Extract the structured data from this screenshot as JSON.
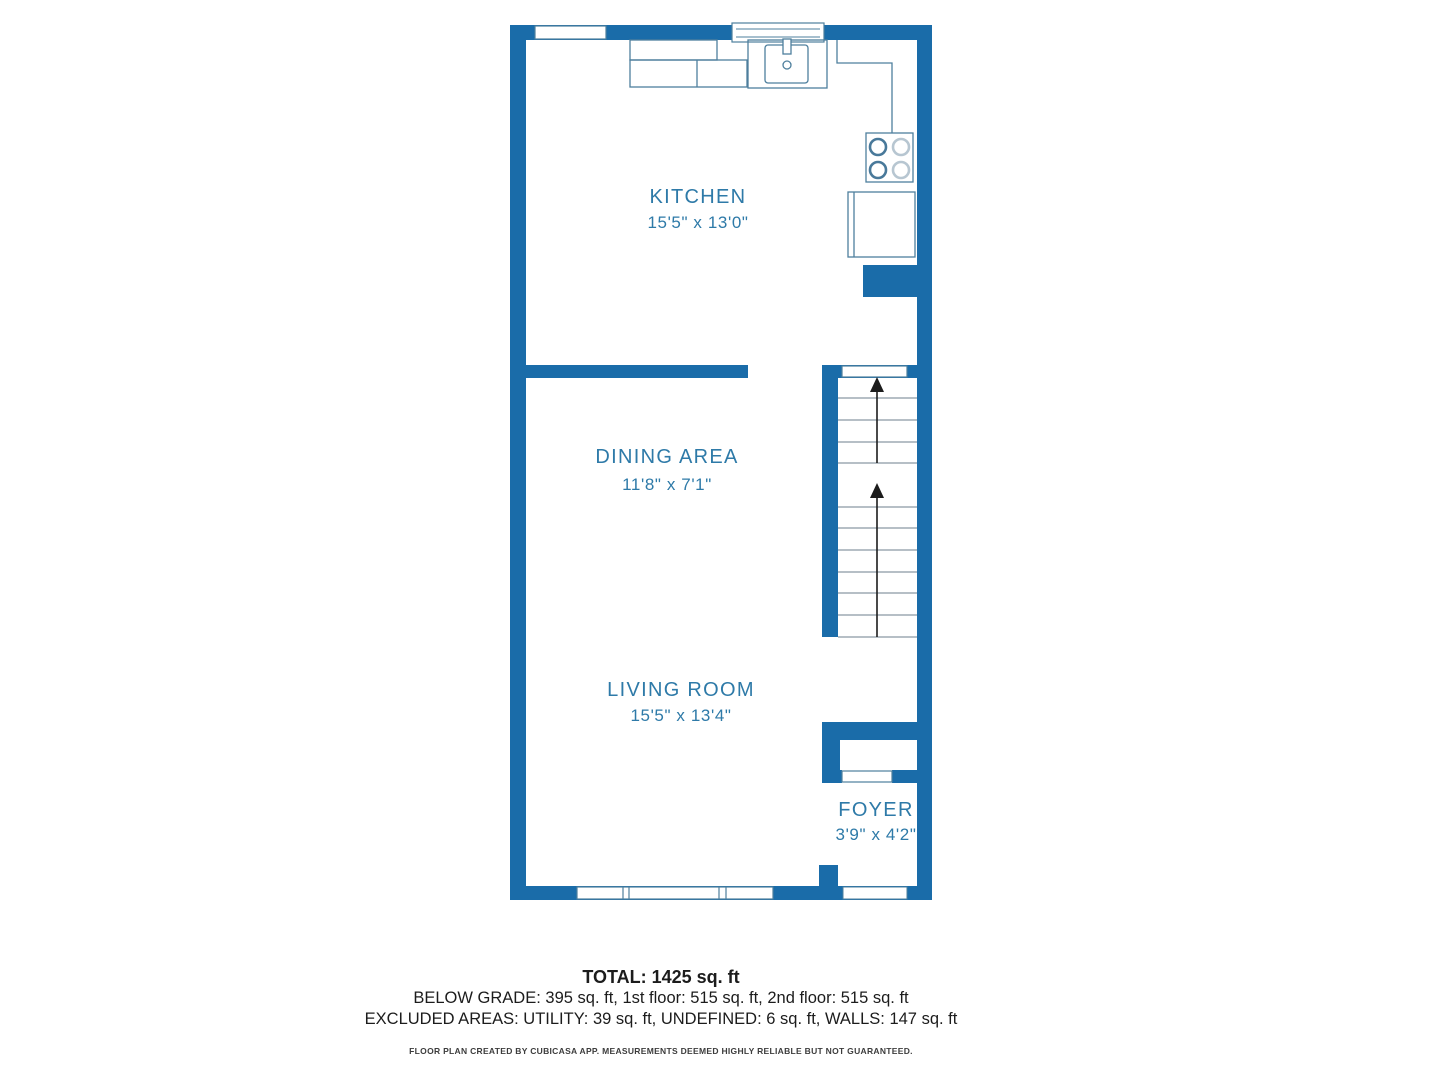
{
  "floor_plan": {
    "colors": {
      "wall_blue": "#1a6ca9",
      "fixture_line": "#4e7f9d",
      "tread_line": "#8a99a4",
      "label_text": "#2e7aa8",
      "arrow_black": "#1c1c1c"
    },
    "rooms": [
      {
        "name": "KITCHEN",
        "dims": "15'5\" x 13'0\""
      },
      {
        "name": "DINING AREA",
        "dims": "11'8\" x 7'1\""
      },
      {
        "name": "LIVING ROOM",
        "dims": "15'5\" x 13'4\""
      },
      {
        "name": "FOYER",
        "dims": "3'9\" x 4'2\""
      }
    ],
    "icons": {
      "stairs": "two flights up with arrows",
      "kitchen": "sink, 4-burner stove, refrigerator, counters",
      "openings": "windows and entry door"
    }
  },
  "summary": {
    "total": "TOTAL: 1425 sq. ft",
    "breakdown": "BELOW GRADE: 395 sq. ft, 1st floor: 515 sq. ft, 2nd floor: 515 sq. ft",
    "excluded": "EXCLUDED AREAS: UTILITY: 39 sq. ft, UNDEFINED: 6 sq. ft, WALLS: 147 sq. ft",
    "disclaimer": "FLOOR PLAN CREATED BY CUBICASA APP. MEASUREMENTS DEEMED HIGHLY RELIABLE BUT NOT GUARANTEED."
  }
}
